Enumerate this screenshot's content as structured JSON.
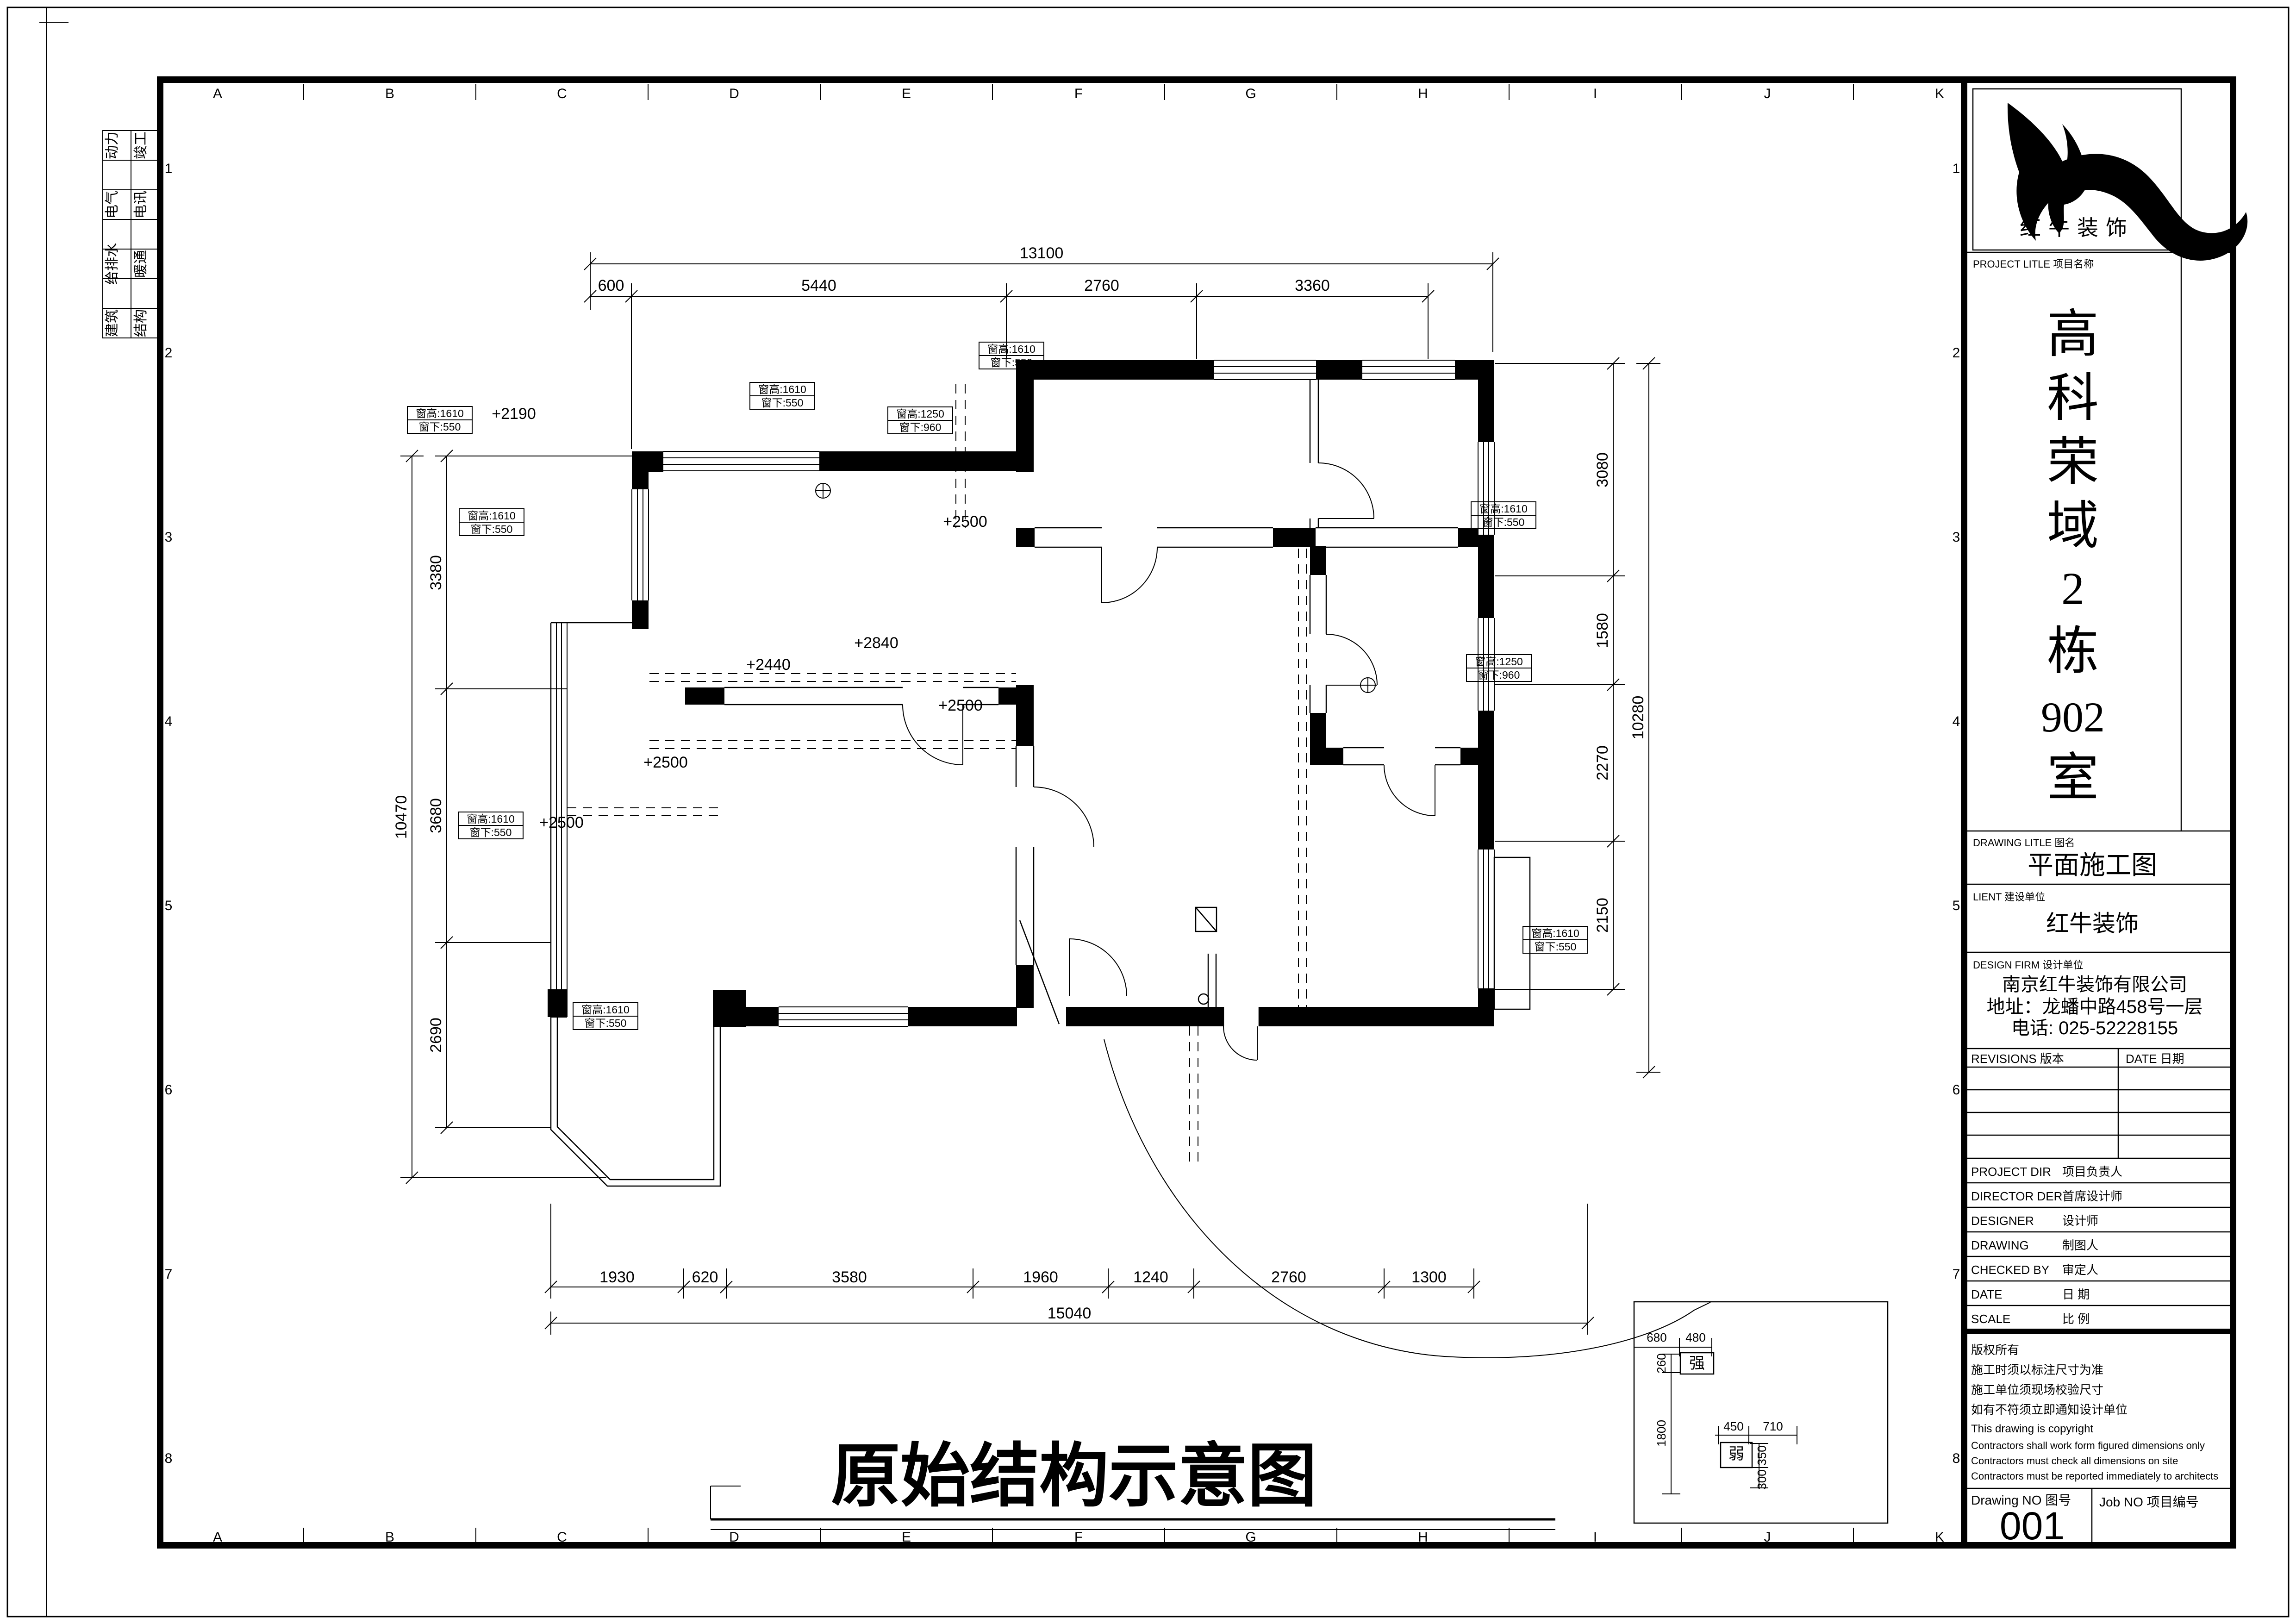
{
  "frame": {
    "cols": [
      "A",
      "B",
      "C",
      "D",
      "E",
      "F",
      "G",
      "H",
      "I",
      "J",
      "K"
    ],
    "rows": [
      "1",
      "2",
      "3",
      "4",
      "5",
      "6",
      "7",
      "8"
    ],
    "disciplines": [
      [
        "动力",
        "竣工"
      ],
      [
        "电气",
        "电讯"
      ],
      [
        "给排水",
        "暖通"
      ],
      [
        "建筑",
        "结构"
      ]
    ]
  },
  "main_title": "原始结构示意图",
  "dims": {
    "top": {
      "total": "13100",
      "segs": [
        "600",
        "5440",
        "2760",
        "3360"
      ]
    },
    "bottom": {
      "total": "15040",
      "segs": [
        "1930",
        "620",
        "3580",
        "1960",
        "1240",
        "2760",
        "1300"
      ]
    },
    "left": {
      "total": "10470",
      "segs": [
        "3380",
        "3680",
        "2690"
      ]
    },
    "right": {
      "total": "10280",
      "segs": [
        "3080",
        "1580",
        "2270",
        "2150"
      ]
    }
  },
  "plan": {
    "levels": [
      "+2190",
      "+2500",
      "+2840",
      "+2440",
      "+2500",
      "+2500",
      "+2500"
    ],
    "window_tags": [
      {
        "h": "窗高:1610",
        "s": "窗下:550"
      },
      {
        "h": "窗高:1610",
        "s": "窗下:550"
      },
      {
        "h": "窗高:1610",
        "s": "窗下:550"
      },
      {
        "h": "窗高:1250",
        "s": "窗下:960"
      },
      {
        "h": "窗高:1610",
        "s": "窗下:550"
      },
      {
        "h": "窗高:1250",
        "s": "窗下:960"
      },
      {
        "h": "窗高:1610",
        "s": "窗下:550"
      },
      {
        "h": "窗高:1610",
        "s": "窗下:550"
      },
      {
        "h": "窗高:1610",
        "s": "窗下:550"
      },
      {
        "h": "窗高:1610",
        "s": "窗下:550"
      }
    ]
  },
  "detail": {
    "strong": "强",
    "weak": "弱",
    "d680": "680",
    "d480": "480",
    "d260": "260",
    "d1800": "1800",
    "d450": "450",
    "d710": "710",
    "d350": "350",
    "d300": "300"
  },
  "tb": {
    "logo_text": "红牛装饰",
    "project_label": "PROJECT LITLE 项目名称",
    "project_chars": [
      "高",
      "科",
      "荣",
      "域",
      "2",
      "栋",
      "902",
      "室"
    ],
    "drawing_label": "DRAWING LITLE 图名",
    "drawing_name": "平面施工图",
    "client_label": "LIENT 建设单位",
    "client_name": "红牛装饰",
    "firm_label": "DESIGN FIRM 设计单位",
    "firm_name": "南京红牛装饰有限公司",
    "firm_addr": "地址：龙蟠中路458号一层",
    "firm_tel": "电话: 025-52228155",
    "revisions_label": "REVISIONS 版本",
    "date_label": "DATE 日期",
    "rows": [
      [
        "PROJECT DIR",
        "项目负责人"
      ],
      [
        "DIRECTOR DER",
        "首席设计师"
      ],
      [
        "DESIGNER",
        "设计师"
      ],
      [
        "DRAWING",
        "制图人"
      ],
      [
        "CHECKED BY",
        "审定人"
      ],
      [
        "DATE",
        "日  期"
      ],
      [
        "SCALE",
        "比  例"
      ]
    ],
    "copyright": [
      "版权所有",
      "施工时须以标注尺寸为准",
      "施工单位须现场校验尺寸",
      "如有不符须立即通知设计单位",
      "This drawing is copyright",
      "Contractors shall work form figured dimensions only",
      "Contractors must check all dimensions on site",
      "Contractors must be reported immediately to architects"
    ],
    "drawno_label": "Drawing NO 图号",
    "drawno": "001",
    "jobno_label": "Job NO 项目编号"
  }
}
